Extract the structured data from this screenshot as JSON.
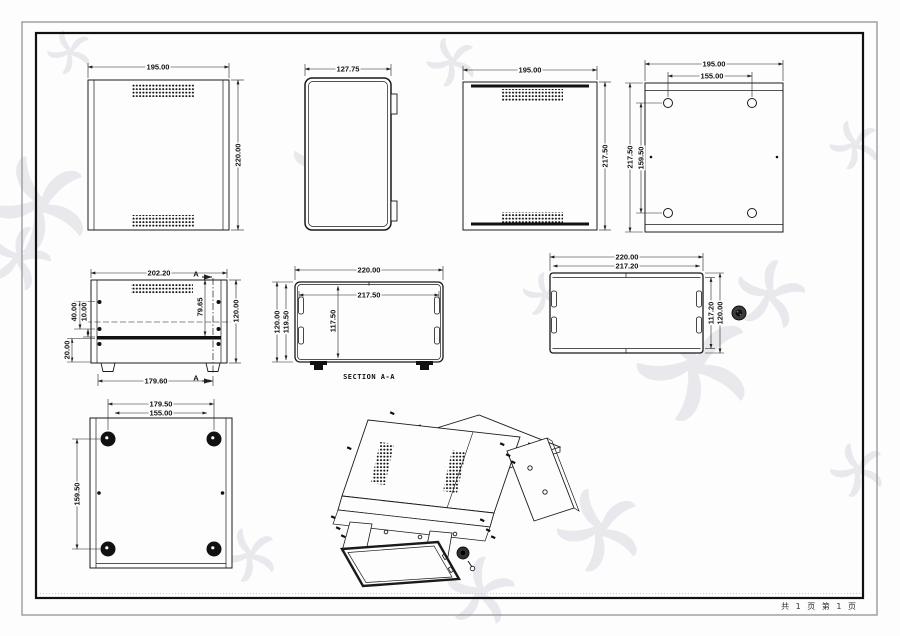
{
  "page": {
    "footer": "共 1 页 第 1 页"
  },
  "views": {
    "front": {
      "w": "195.00",
      "h": "220.00"
    },
    "side": {
      "w": "127.75"
    },
    "rear": {
      "w": "195.00",
      "h": "217.50"
    },
    "mount_panel": {
      "w": "195.00",
      "hole_w": "155.00",
      "h": "217.50",
      "hole_h": "159.50"
    },
    "back_assembly": {
      "w": "202.20",
      "base_w": "179.60",
      "h": "120.00",
      "vent_pos": "79.65",
      "d40": "40.00",
      "d10": "10.00",
      "d20": "20.00",
      "section_label": "A"
    },
    "section": {
      "caption": "SECTION A-A",
      "w_outer": "220.00",
      "w_inner": "217.50",
      "h_outer": "120.00",
      "h_mid": "119.50",
      "h_inner": "117.50"
    },
    "top_cover": {
      "w_outer": "220.00",
      "w_inner": "217.20",
      "h_inner": "117.20",
      "h_outer": "120.00"
    },
    "bottom": {
      "feet_w": "179.50",
      "hole_w": "155.00",
      "feet_h": "159.50"
    }
  },
  "colors": {
    "line": "#1a1a1a",
    "dim_line": "#222222",
    "border": "#111111",
    "watermark": "#e9e9ed"
  }
}
